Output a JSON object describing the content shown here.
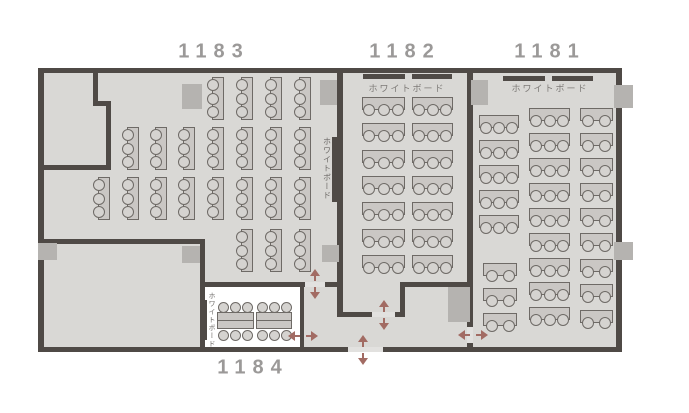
{
  "page": {
    "type": "seating-floor-plan",
    "rooms_shown": [
      "1183",
      "1182",
      "1181",
      "1184"
    ]
  },
  "rooms": [
    {
      "id": "1183",
      "label": "1183"
    },
    {
      "id": "1182",
      "label": "1182"
    },
    {
      "id": "1181",
      "label": "1181"
    },
    {
      "id": "1184",
      "label": "1184"
    }
  ],
  "whiteboards": [
    {
      "room": "1182",
      "label": "ホワイトボード",
      "orientation": "horizontal",
      "wall": "north"
    },
    {
      "room": "1181",
      "label": "ホワイトボード",
      "orientation": "horizontal",
      "wall": "north"
    },
    {
      "room": "1183",
      "label": "ホワイトボード",
      "orientation": "vertical",
      "wall": "east"
    },
    {
      "room": "1184",
      "label": "ホワイトボード",
      "orientation": "vertical",
      "wall": "west"
    }
  ],
  "seating_summary": {
    "1183": {
      "tables_3seat": 22,
      "seats": 66
    },
    "1182": {
      "tables_3seat": 14,
      "seats": 42
    },
    "1181": {
      "tables_3seat": 14,
      "tables_2seat": 12,
      "seats": 66
    },
    "1184": {
      "island_tables": 2,
      "seats": 12
    }
  },
  "colors": {
    "floor": "#d9d8d5",
    "room1184_floor": "#ffffff",
    "wall": "#4f4a46",
    "pillar": "#b5b3b0",
    "table": "#cac7c4",
    "chair": "#d5d3d0",
    "furniture_border": "#6e6a66",
    "threshold": "#e2e1df",
    "arrow": "#a26b63",
    "label": "#9b9998"
  },
  "layout": {
    "canvas": {
      "w": 689,
      "h": 413
    },
    "floor": [
      38,
      68,
      584,
      284
    ],
    "room1184_floor": [
      204,
      287,
      96,
      60
    ],
    "walls": [
      [
        38,
        68,
        584,
        5
      ],
      [
        38,
        68,
        6,
        284
      ],
      [
        616,
        68,
        6,
        284
      ],
      [
        38,
        347,
        310,
        5
      ],
      [
        383,
        347,
        239,
        5
      ],
      [
        93,
        68,
        5,
        38
      ],
      [
        93,
        101,
        18,
        5
      ],
      [
        106,
        101,
        5,
        69
      ],
      [
        38,
        165,
        73,
        5
      ],
      [
        337,
        68,
        6,
        249
      ],
      [
        337,
        312,
        35,
        5
      ],
      [
        395,
        312,
        10,
        5
      ],
      [
        400,
        282,
        5,
        35
      ],
      [
        400,
        282,
        73,
        5
      ],
      [
        467,
        68,
        6,
        259
      ],
      [
        467,
        343,
        6,
        9
      ],
      [
        38,
        239,
        167,
        5
      ],
      [
        200,
        239,
        5,
        113
      ],
      [
        200,
        282,
        105,
        5
      ],
      [
        325,
        282,
        18,
        5
      ],
      [
        300,
        287,
        4,
        61
      ]
    ],
    "thresholds": [
      [
        348,
        347,
        35,
        5
      ],
      [
        372,
        312,
        23,
        5
      ],
      [
        305,
        282,
        20,
        5
      ],
      [
        467,
        327,
        6,
        16
      ]
    ],
    "pillars": [
      [
        182,
        84,
        20,
        25
      ],
      [
        320,
        80,
        17,
        25
      ],
      [
        471,
        80,
        17,
        25
      ],
      [
        614,
        85,
        19,
        23
      ],
      [
        38,
        243,
        19,
        17
      ],
      [
        182,
        246,
        18,
        17
      ],
      [
        322,
        245,
        17,
        17
      ],
      [
        448,
        287,
        22,
        35
      ],
      [
        614,
        242,
        19,
        18
      ]
    ],
    "wb_bars": [
      [
        363,
        74,
        42,
        5
      ],
      [
        412,
        74,
        40,
        5
      ],
      [
        503,
        76,
        42,
        5
      ],
      [
        552,
        76,
        41,
        5
      ],
      [
        332,
        137,
        5,
        65
      ],
      [
        203,
        300,
        4,
        40
      ]
    ],
    "tables_v3": [
      [
        207,
        77
      ],
      [
        236,
        77
      ],
      [
        265,
        77
      ],
      [
        294,
        77
      ],
      [
        122,
        127
      ],
      [
        150,
        127
      ],
      [
        178,
        127
      ],
      [
        207,
        127
      ],
      [
        236,
        127
      ],
      [
        265,
        127
      ],
      [
        294,
        127
      ],
      [
        93,
        177
      ],
      [
        122,
        177
      ],
      [
        150,
        177
      ],
      [
        178,
        177
      ],
      [
        207,
        177
      ],
      [
        236,
        177
      ],
      [
        265,
        177
      ],
      [
        294,
        177
      ],
      [
        236,
        229
      ],
      [
        265,
        229
      ],
      [
        294,
        229
      ]
    ],
    "tables_h": [
      {
        "room": "1182",
        "x": 362,
        "w": 43,
        "seats": 3,
        "rows": [
          97,
          123,
          150,
          176,
          202,
          229,
          255
        ]
      },
      {
        "room": "1182",
        "x": 412,
        "w": 41,
        "seats": 3,
        "rows": [
          97,
          123,
          150,
          176,
          202,
          229,
          255
        ]
      },
      {
        "room": "1181",
        "x": 479,
        "w": 40,
        "seats": 3,
        "rows": [
          115,
          140,
          165,
          190,
          215
        ]
      },
      {
        "room": "1181",
        "x": 529,
        "w": 41,
        "seats": 3,
        "rows": [
          108,
          133,
          158,
          183,
          208,
          233,
          258,
          282,
          307
        ]
      },
      {
        "room": "1181",
        "x": 483,
        "w": 34,
        "seats": 2,
        "rows": [
          263,
          288,
          313
        ]
      },
      {
        "room": "1181",
        "x": 580,
        "w": 33,
        "seats": 2,
        "rows": [
          108,
          133,
          158,
          183,
          208,
          233,
          259,
          284,
          310
        ]
      }
    ],
    "islands": [
      {
        "room": "1184",
        "x": 217,
        "y": 312,
        "w": 37
      },
      {
        "room": "1184",
        "x": 256,
        "y": 312,
        "w": 36
      }
    ],
    "arrows": [
      {
        "dir": "v",
        "cx": 315,
        "cy": 284
      },
      {
        "dir": "h",
        "cx": 303,
        "cy": 336
      },
      {
        "dir": "v",
        "cx": 384,
        "cy": 315
      },
      {
        "dir": "v",
        "cx": 363,
        "cy": 350
      },
      {
        "dir": "h",
        "cx": 473,
        "cy": 335
      }
    ]
  }
}
